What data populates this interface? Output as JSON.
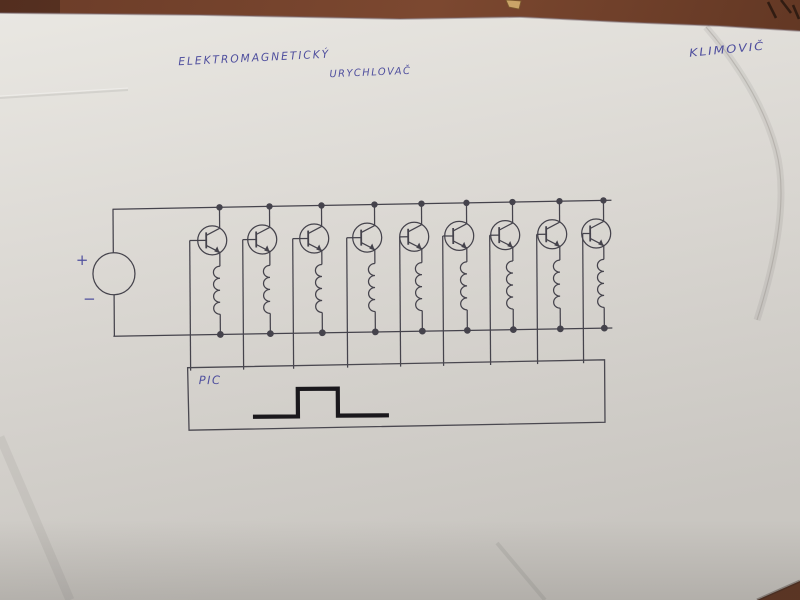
{
  "photo": {
    "kind": "photograph of a hand-drawn electronic schematic on white paper lying on a brown desk",
    "desk_color": "#74422e",
    "paper_color": "#d9d6d1",
    "ink_color": "#45434c",
    "pen_color": "#4f4f9e",
    "marker_color": "#1a181c"
  },
  "titles": {
    "line1": "ELEKTROMAGNETICKÝ",
    "line2": "URYCHLOVAČ",
    "author": "KLIMOVIČ"
  },
  "schematic": {
    "source": {
      "plus": "+",
      "minus": "−"
    },
    "stage_count": 9,
    "stage_description": "NPN transistor with collector to top rail, emitter through coil to bottom rail, base wired down to controller box",
    "controller_label": "PIC",
    "waveform": "single rectangular pulse drawn in thick marker inside controller box"
  }
}
